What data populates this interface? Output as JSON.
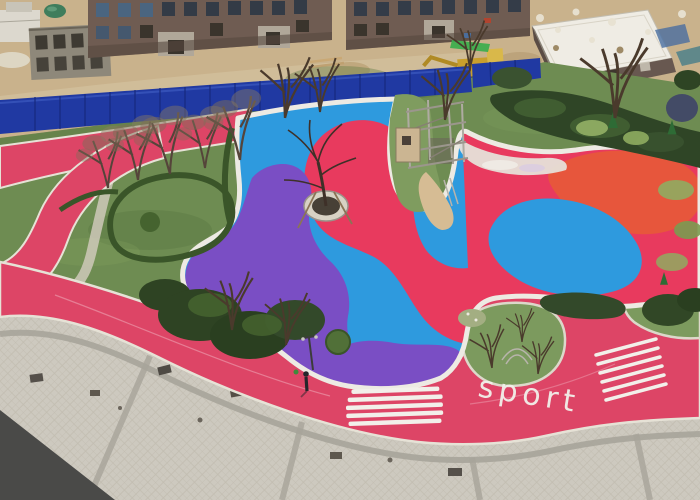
{
  "scene": {
    "description": "Aerial photo of a residential community playground under construction: colorful rubber play surfaces, pink jogging track, lawns, paved plaza, blue construction fence and unfinished buildings",
    "track_label": "sport",
    "colors": {
      "playground_blue": "#2E9ADE",
      "playground_red": "#E83A5E",
      "playground_purple": "#7A4EC4",
      "playground_orange": "#E7563C",
      "track_pink": "#DD4566",
      "lawn_green": "#6E8C52",
      "island_green": "#7C9A5E",
      "hedge_green": "#2F4526",
      "fence_blue": "#2039A2",
      "pavement_gray": "#CDC9BF",
      "dirt_tan": "#C9B28C",
      "stripe_white": "#F2F0EA",
      "concrete_white": "#E6E2D6"
    }
  }
}
